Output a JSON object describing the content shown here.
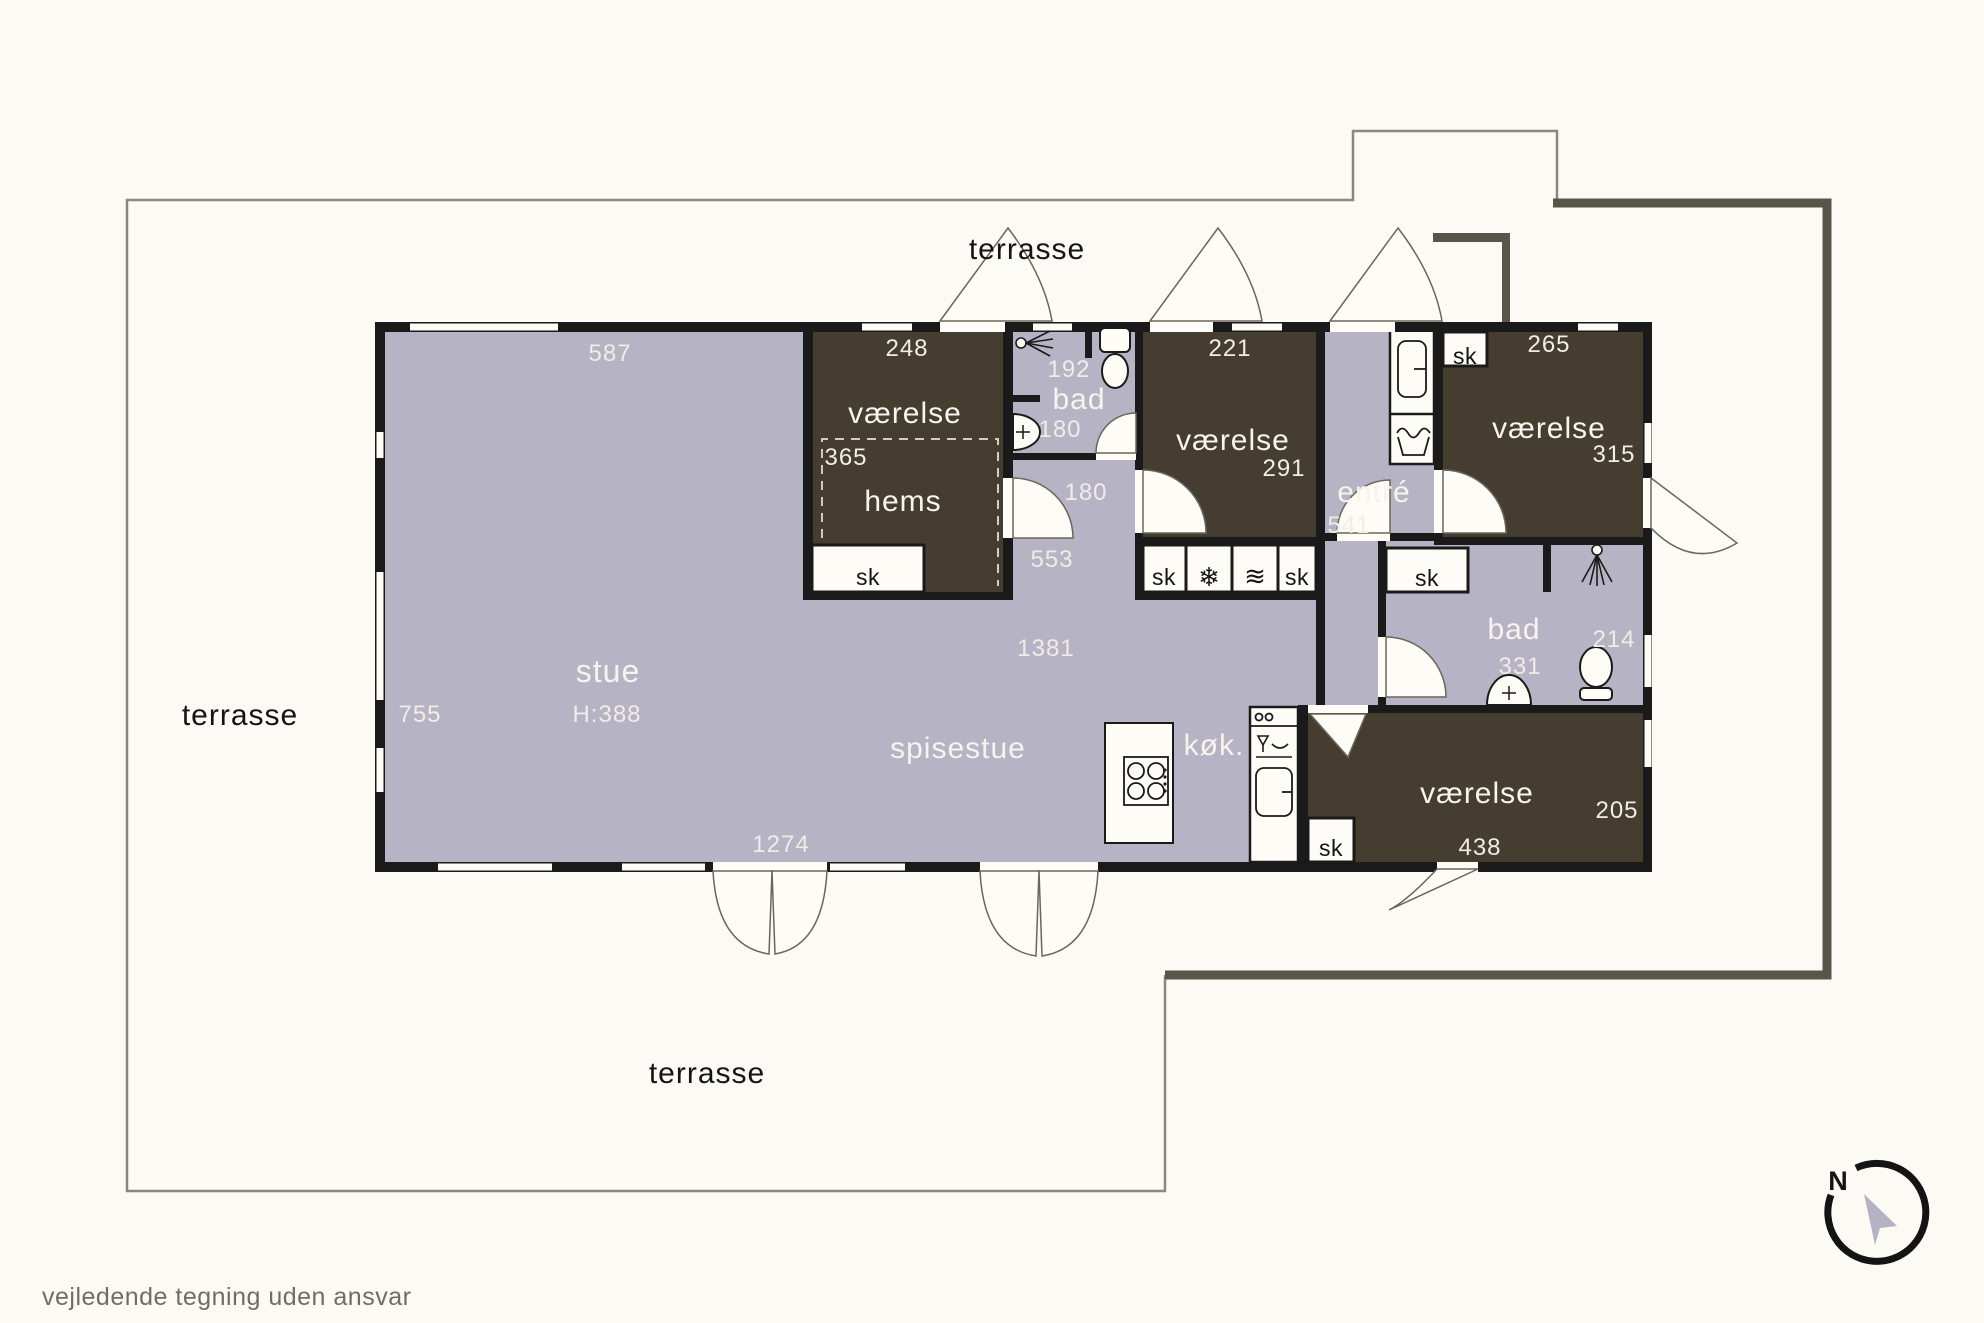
{
  "terrace": {
    "label_top": "terrasse",
    "label_left": "terrasse",
    "label_bottom": "terrasse"
  },
  "rooms": {
    "stue": {
      "label": "stue",
      "ceiling_height": "H:388",
      "dim_top": "587",
      "dim_left": "755",
      "dim_right": "1381",
      "dim_bottom": "1274"
    },
    "spisestue": {
      "label": "spisestue"
    },
    "koekken": {
      "label": "køk."
    },
    "vaerelse_hems": {
      "label": "værelse",
      "hems_label": "hems",
      "dim_top": "248",
      "dim_left": "365",
      "closet": "sk"
    },
    "bad_top": {
      "label": "bad",
      "dim_top": "192",
      "dim_bottom": "180"
    },
    "hall_top": {
      "dim_width": "180",
      "dim_length": "553"
    },
    "vaerelse_mid": {
      "label": "værelse",
      "dim_top": "221",
      "dim_right": "291"
    },
    "closet_row": {
      "sk_left": "sk",
      "freezer_glyph": "❄",
      "waves_glyph": "≋",
      "sk_right": "sk"
    },
    "entre": {
      "label": "entré",
      "dim": "541"
    },
    "vaerelse_ne": {
      "label": "værelse",
      "dim_top": "265",
      "dim_right": "315",
      "closet": "sk"
    },
    "bad_right": {
      "label": "bad",
      "dim_width": "331",
      "dim_right": "214",
      "closet": "sk"
    },
    "vaerelse_se": {
      "label": "værelse",
      "dim_bottom": "438",
      "dim_right": "205",
      "closet": "sk"
    }
  },
  "compass": {
    "north": "N"
  },
  "footer": {
    "disclaimer": "vejledende tegning uden ansvar"
  },
  "colors": {
    "background": "#fbfaf4",
    "floor_light": "#b6b3c4",
    "room_dark": "#453e30",
    "wall": "#1a1a1a",
    "outline_thin": "#8c887e",
    "outline_thick": "#5a554b"
  }
}
